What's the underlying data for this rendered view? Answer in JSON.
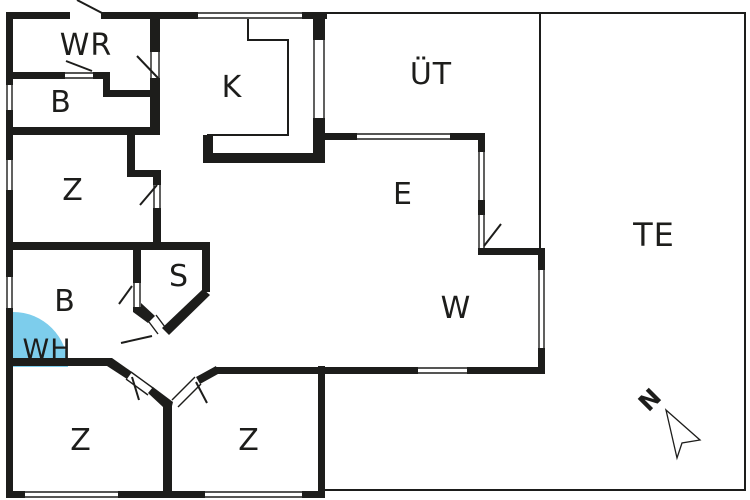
{
  "floor_plan": {
    "rooms": [
      {
        "id": "wr",
        "label": "WR"
      },
      {
        "id": "b_upper",
        "label": "B"
      },
      {
        "id": "k",
        "label": "K"
      },
      {
        "id": "uet",
        "label": "ÜT"
      },
      {
        "id": "e",
        "label": "E"
      },
      {
        "id": "z_left",
        "label": "Z"
      },
      {
        "id": "s",
        "label": "S"
      },
      {
        "id": "b_lower",
        "label": "B"
      },
      {
        "id": "wh",
        "label": "WH"
      },
      {
        "id": "w",
        "label": "W"
      },
      {
        "id": "te",
        "label": "TE"
      },
      {
        "id": "z_bottom_left",
        "label": "Z"
      },
      {
        "id": "z_bottom_right",
        "label": "Z"
      }
    ],
    "compass": {
      "label": "N"
    },
    "colors": {
      "wall": "#1d1d1b",
      "background": "#ffffff",
      "whirlpool": "#7dcdec",
      "text": "#1d1d1b"
    }
  }
}
